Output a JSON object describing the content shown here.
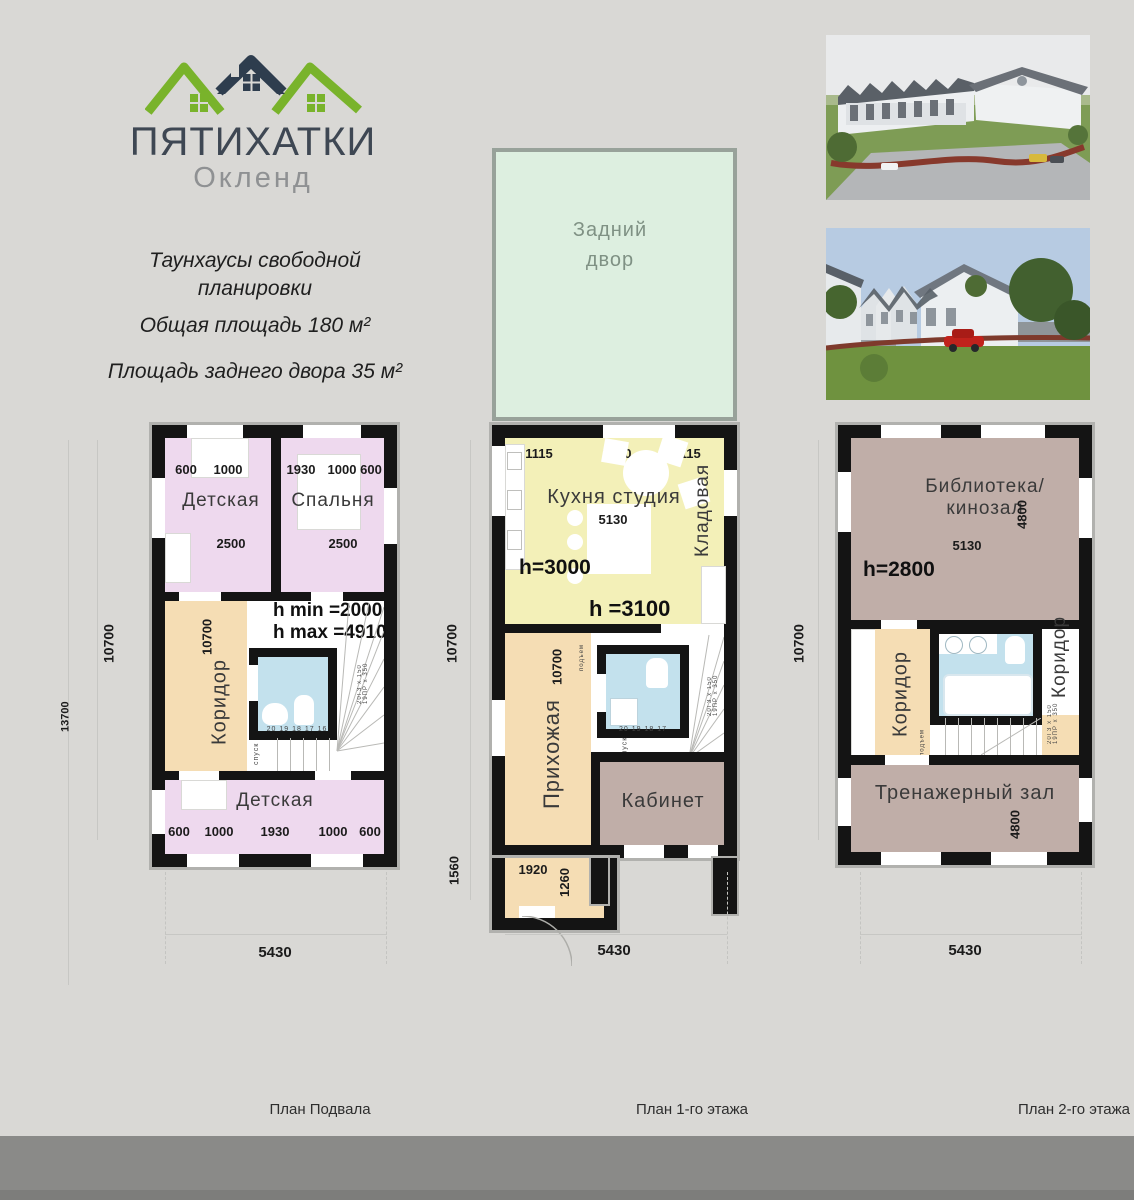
{
  "logo": {
    "title": "ПЯТИХАТКИ",
    "subtitle": "Окленд"
  },
  "intro": {
    "line1": "Таунхаусы свободной",
    "line2": "планировки",
    "line3": "Общая площадь 180 м²",
    "line4": "Площадь заднего двора 35 м²"
  },
  "yard": {
    "label1": "Задний",
    "label2": "двор"
  },
  "captions": {
    "basement": "План Подвала",
    "first": "План 1-го этажа",
    "second": "План 2-го этажа"
  },
  "basement": {
    "out_v": "10700",
    "out_v2": "13700",
    "out_w": "5430",
    "tl_name": "Детская",
    "tl_d1": "600",
    "tl_d2": "1000",
    "tl_w": "2500",
    "tr_name": "Спальня",
    "tr_d1": "1930",
    "tr_d2": "1000",
    "tr_d3": "600",
    "tr_w": "2500",
    "hmin": "h min =2000",
    "hmax": "h max =4910",
    "corridor": "Коридор",
    "corridor_dim": "10700",
    "steps": "20 19 18 17 16",
    "spusk": "спуск",
    "spec": "20ГЗ x 150  19ПР x 350",
    "bottom_name": "Детская",
    "b_d1": "600",
    "b_d2": "1000",
    "b_d3": "1930",
    "b_d4": "1000",
    "b_d5": "600"
  },
  "first": {
    "out_v": "10700",
    "out_v2": "1560",
    "out_w": "5430",
    "t1": "1115",
    "t2": "2900",
    "t3": "1115",
    "kitchen": "Кухня студия",
    "kitchen_w": "5130",
    "pantry": "Кладовая",
    "h1": "h=3000",
    "h2": "h =3100",
    "hall": "Прихожая",
    "hall_dim": "10700",
    "podem": "подъем",
    "spusk": "спуск",
    "steps": "20 19 18 17",
    "spec": "20ГЗ x 150  19ПР x 350",
    "cabinet": "Кабинет",
    "vest_w": "1920",
    "vest_h": "1260"
  },
  "second": {
    "out_v": "10700",
    "out_w": "5430",
    "lib1": "Библиотека/",
    "lib2": "кинозал",
    "lib_v": "4800",
    "lib_w": "5130",
    "h": "h=2800",
    "cor_left": "Коридор",
    "cor_right": "Коридор",
    "podem": "подъем",
    "spec": "20ГЗ x 150  19ПР x 350",
    "gym": "Тренажерный зал",
    "gym_v": "4800"
  },
  "colors": {
    "background": "#d9d8d5",
    "wall": "#141414",
    "rooms_pink": "#eed9ee",
    "rooms_tan": "#f5ddb4",
    "rooms_yellow": "#f3f0b8",
    "bath_blue": "#c3e1ed",
    "rooms_mauve": "#c0aea8",
    "yard_green": "#ddefe0",
    "logo_green": "#79b32b",
    "logo_dark": "#2e3d4e",
    "footer": "#8a8a88"
  }
}
